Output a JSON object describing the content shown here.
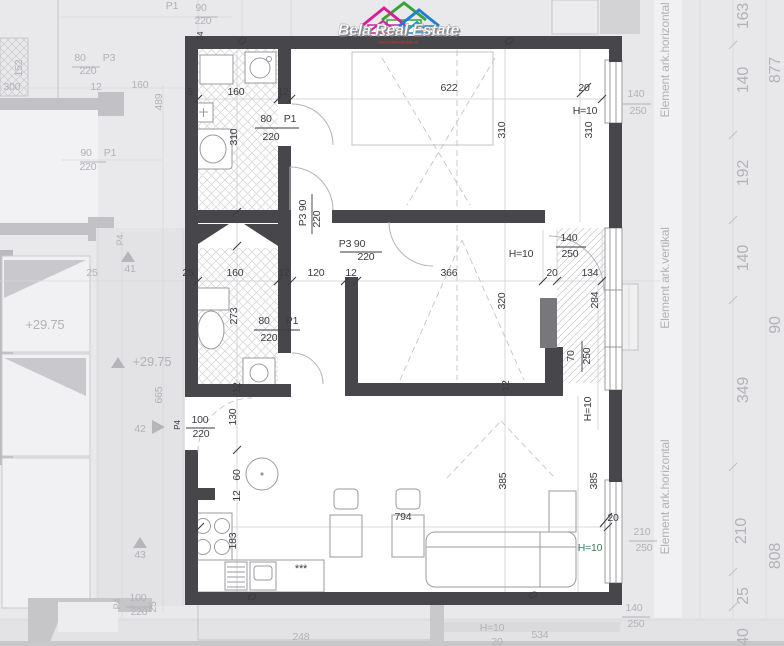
{
  "colors": {
    "wall": "#47474b",
    "d": "#3b3b40",
    "f": "#b2b2b7",
    "g": "#3f7a58",
    "accent_pink": "#d4219a",
    "accent_green": "#35a435",
    "accent_blue": "#1d7fd4",
    "accent_teal": "#16a0b4"
  },
  "logo": {
    "title": "Bela Real Estate",
    "subtitle": "www.belarealestate.al"
  },
  "plan": {
    "labels": [
      {
        "t": "160",
        "x": 236,
        "y": 95
      },
      {
        "t": "12",
        "x": 283,
        "y": 95
      },
      {
        "t": "5",
        "x": 190,
        "y": 95
      },
      {
        "t": "622",
        "x": 449,
        "y": 91
      },
      {
        "t": "20",
        "x": 584,
        "y": 91
      },
      {
        "t": "H=10",
        "x": 585,
        "y": 114
      },
      {
        "t": "310",
        "x": 237,
        "y": 137,
        "r": -90
      },
      {
        "t": "310",
        "x": 505,
        "y": 130,
        "r": -90
      },
      {
        "t": "310",
        "x": 592,
        "y": 130,
        "r": -90
      },
      {
        "t": "80",
        "x": 266,
        "y": 122
      },
      {
        "t": "P1",
        "x": 290,
        "y": 122
      },
      {
        "t": "220",
        "x": 271,
        "y": 140
      },
      {
        "t": "24",
        "x": 203,
        "y": 36,
        "r": -90,
        "s": 8
      },
      {
        "t": "P3 90",
        "x": 306,
        "y": 213,
        "r": -90
      },
      {
        "t": "220",
        "x": 320,
        "y": 219,
        "r": -90
      },
      {
        "t": "P3 90",
        "x": 352,
        "y": 247
      },
      {
        "t": "220",
        "x": 366,
        "y": 260
      },
      {
        "t": "25",
        "x": 188,
        "y": 276
      },
      {
        "t": "160",
        "x": 235,
        "y": 276
      },
      {
        "t": "12",
        "x": 284,
        "y": 276
      },
      {
        "t": "120",
        "x": 316,
        "y": 276
      },
      {
        "t": "12",
        "x": 351,
        "y": 276
      },
      {
        "t": "366",
        "x": 449,
        "y": 276
      },
      {
        "t": "20",
        "x": 552,
        "y": 276
      },
      {
        "t": "134",
        "x": 590,
        "y": 276
      },
      {
        "t": "H=10",
        "x": 521,
        "y": 257
      },
      {
        "t": "140",
        "x": 569,
        "y": 241
      },
      {
        "t": "250",
        "x": 570,
        "y": 257
      },
      {
        "t": "320",
        "x": 505,
        "y": 301,
        "r": -90
      },
      {
        "t": "284",
        "x": 598,
        "y": 300,
        "r": -90
      },
      {
        "t": "70",
        "x": 574,
        "y": 356,
        "r": -90
      },
      {
        "t": "250",
        "x": 590,
        "y": 356,
        "r": -90
      },
      {
        "t": "12",
        "x": 509,
        "y": 386,
        "r": -90
      },
      {
        "t": "H=10",
        "x": 591,
        "y": 409,
        "r": -90
      },
      {
        "t": "273",
        "x": 237,
        "y": 316,
        "r": -90
      },
      {
        "t": "80",
        "x": 264,
        "y": 324
      },
      {
        "t": "P1",
        "x": 292,
        "y": 324
      },
      {
        "t": "220",
        "x": 269,
        "y": 341
      },
      {
        "t": "12",
        "x": 240,
        "y": 388,
        "r": -90
      },
      {
        "t": "P4",
        "x": 180,
        "y": 425,
        "r": -90,
        "s": 8
      },
      {
        "t": "100",
        "x": 200,
        "y": 423
      },
      {
        "t": "220",
        "x": 201,
        "y": 437
      },
      {
        "t": "130",
        "x": 236,
        "y": 417,
        "r": -90
      },
      {
        "t": "60",
        "x": 240,
        "y": 475,
        "r": -90
      },
      {
        "t": "12",
        "x": 240,
        "y": 496,
        "r": -90
      },
      {
        "t": "183",
        "x": 236,
        "y": 541,
        "r": -90
      },
      {
        "t": "794",
        "x": 403,
        "y": 520
      },
      {
        "t": "385",
        "x": 506,
        "y": 481,
        "r": -90
      },
      {
        "t": "385",
        "x": 597,
        "y": 481,
        "r": -90
      },
      {
        "t": "20",
        "x": 613,
        "y": 521
      },
      {
        "t": "H=10",
        "x": 590,
        "y": 551,
        "c": "g"
      },
      {
        "t": "***",
        "x": 301,
        "y": 572,
        "s": 11
      },
      {
        "t": "140",
        "x": 636,
        "y": 97,
        "c": "f"
      },
      {
        "t": "250",
        "x": 638,
        "y": 114,
        "c": "f"
      },
      {
        "t": "210",
        "x": 642,
        "y": 535,
        "c": "f"
      },
      {
        "t": "250",
        "x": 644,
        "y": 551,
        "c": "f"
      },
      {
        "t": "140",
        "x": 634,
        "y": 611,
        "c": "f"
      },
      {
        "t": "250",
        "x": 636,
        "y": 627,
        "c": "f"
      },
      {
        "t": "P1",
        "x": 172,
        "y": 9,
        "c": "f"
      },
      {
        "t": "90",
        "x": 201,
        "y": 11,
        "c": "f"
      },
      {
        "t": "220",
        "x": 203,
        "y": 24,
        "c": "f"
      },
      {
        "t": "152",
        "x": 22,
        "y": 68,
        "r": -90,
        "c": "f"
      },
      {
        "t": "300",
        "x": 12,
        "y": 90,
        "c": "f"
      },
      {
        "t": "80",
        "x": 80,
        "y": 61,
        "c": "f"
      },
      {
        "t": "P3",
        "x": 109,
        "y": 61,
        "c": "f"
      },
      {
        "t": "220",
        "x": 88,
        "y": 74,
        "c": "f"
      },
      {
        "t": "12",
        "x": 96,
        "y": 90,
        "c": "f"
      },
      {
        "t": "160",
        "x": 140,
        "y": 88,
        "c": "f"
      },
      {
        "t": "489",
        "x": 162,
        "y": 102,
        "r": -90,
        "c": "f"
      },
      {
        "t": "90",
        "x": 86,
        "y": 156,
        "c": "f"
      },
      {
        "t": "P1",
        "x": 110,
        "y": 156,
        "c": "f"
      },
      {
        "t": "220",
        "x": 88,
        "y": 170,
        "c": "f"
      },
      {
        "t": "P4",
        "x": 123,
        "y": 240,
        "r": -90,
        "s": 9,
        "c": "f"
      },
      {
        "t": "41",
        "x": 130,
        "y": 272,
        "c": "f"
      },
      {
        "t": "25",
        "x": 92,
        "y": 276,
        "c": "f"
      },
      {
        "t": "+29.75",
        "x": 45,
        "y": 329,
        "c": "f",
        "s": 13
      },
      {
        "t": "+29.75",
        "x": 152,
        "y": 366,
        "c": "f",
        "s": 13
      },
      {
        "t": "665",
        "x": 162,
        "y": 395,
        "r": -90,
        "c": "f"
      },
      {
        "t": "42",
        "x": 140,
        "y": 432,
        "c": "f"
      },
      {
        "t": "43",
        "x": 140,
        "y": 558,
        "c": "f"
      },
      {
        "t": "P4",
        "x": 120,
        "y": 604,
        "r": -90,
        "s": 9,
        "c": "f"
      },
      {
        "t": "100",
        "x": 138,
        "y": 601,
        "c": "f"
      },
      {
        "t": "220",
        "x": 139,
        "y": 615,
        "c": "f"
      },
      {
        "t": "25",
        "x": 156,
        "y": 607,
        "r": -90,
        "c": "f"
      },
      {
        "t": "248",
        "x": 301,
        "y": 640,
        "c": "f"
      },
      {
        "t": "534",
        "x": 540,
        "y": 638,
        "c": "f"
      },
      {
        "t": "H=10",
        "x": 492,
        "y": 631,
        "c": "f"
      },
      {
        "t": "20",
        "x": 497,
        "y": 645,
        "c": "f"
      },
      {
        "t": "163",
        "x": 748,
        "y": 16,
        "r": -90,
        "s": 16,
        "c": "f"
      },
      {
        "t": "877",
        "x": 780,
        "y": 70,
        "r": -90,
        "s": 16,
        "c": "f"
      },
      {
        "t": "140",
        "x": 748,
        "y": 80,
        "r": -90,
        "s": 16,
        "c": "f"
      },
      {
        "t": "192",
        "x": 748,
        "y": 173,
        "r": -90,
        "s": 16,
        "c": "f"
      },
      {
        "t": "140",
        "x": 748,
        "y": 258,
        "r": -90,
        "s": 16,
        "c": "f"
      },
      {
        "t": "90",
        "x": 780,
        "y": 325,
        "r": -90,
        "s": 16,
        "c": "f"
      },
      {
        "t": "349",
        "x": 748,
        "y": 390,
        "r": -90,
        "s": 16,
        "c": "f"
      },
      {
        "t": "210",
        "x": 746,
        "y": 531,
        "r": -90,
        "s": 16,
        "c": "f"
      },
      {
        "t": "808",
        "x": 780,
        "y": 556,
        "r": -90,
        "s": 16,
        "c": "f"
      },
      {
        "t": "25",
        "x": 748,
        "y": 596,
        "r": -90,
        "s": 16,
        "c": "f"
      },
      {
        "t": "40",
        "x": 748,
        "y": 637,
        "r": -90,
        "s": 16,
        "c": "f"
      },
      {
        "t": "Element ark.horizontal",
        "x": 669,
        "y": 60,
        "r": -90,
        "s": 12,
        "c": "f"
      },
      {
        "t": "Element ark.vertikal",
        "x": 669,
        "y": 278,
        "r": -90,
        "s": 12,
        "c": "f"
      },
      {
        "t": "Element ark.horizontal",
        "x": 669,
        "y": 497,
        "r": -90,
        "s": 12,
        "c": "f"
      }
    ]
  }
}
